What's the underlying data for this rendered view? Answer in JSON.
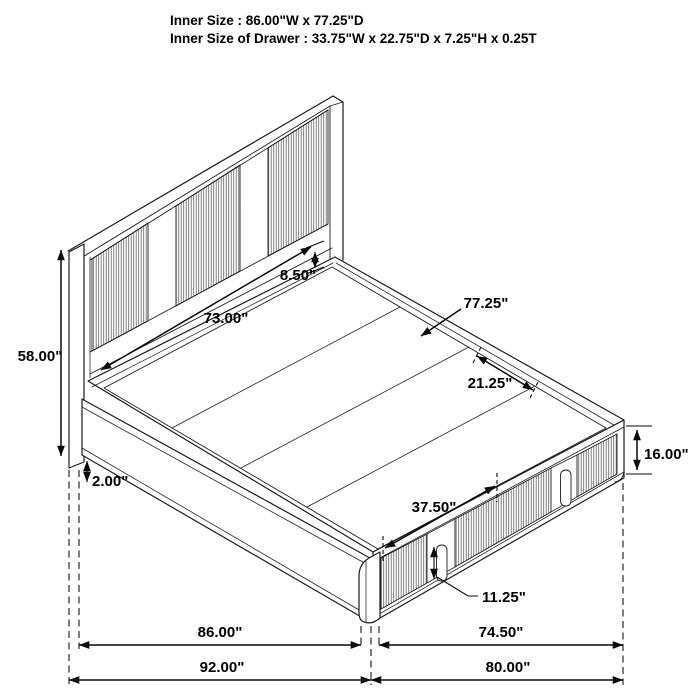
{
  "title": {
    "line1": "Inner Size : 86.00\"W x 77.25\"D",
    "line2": "Inner Size of Drawer : 33.75\"W x 22.75\"D x 7.25\"H x 0.25T"
  },
  "dims": {
    "headboard_height": "58.00\"",
    "floor_clearance": "2.00\"",
    "headboard_panel_width": "73.00\"",
    "headboard_rail_gap": "8.50\"",
    "inner_depth": "77.25\"",
    "deck_section": "21.25\"",
    "footboard_height": "16.00\"",
    "drawer_span": "37.50\"",
    "drawer_front_height": "11.25\"",
    "inner_width": "86.00\"",
    "footboard_inner_width": "74.50\"",
    "overall_width": "92.00\"",
    "footboard_overall_width": "80.00\""
  },
  "colors": {
    "line": "#1c1c1c",
    "hatch": "#6a6a6a",
    "background": "#ffffff",
    "text": "#000000"
  }
}
